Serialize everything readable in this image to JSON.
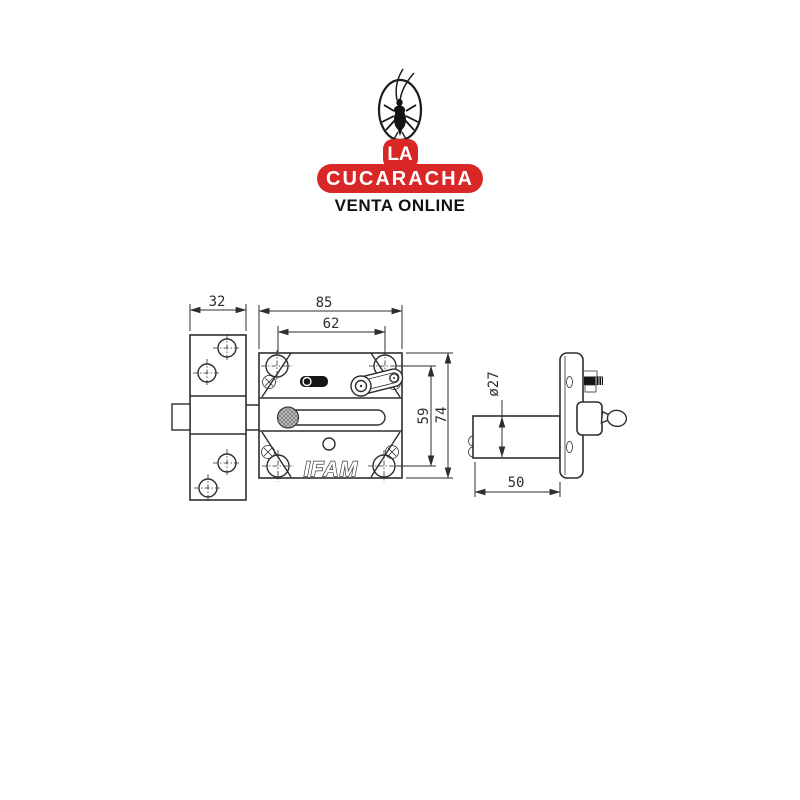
{
  "logo": {
    "brand_line1": "LA",
    "brand_line2": "CUCARACHA",
    "tagline": "VENTA ONLINE",
    "mascot": "cockroach-icon"
  },
  "drawing": {
    "brand_label": "IFAM",
    "dims": {
      "keeper_width": "32",
      "body_width": "85",
      "hole_spacing_horizontal": "62",
      "hole_spacing_vertical": "59",
      "body_height": "74",
      "cylinder_diameter": "ø27",
      "cylinder_length": "50"
    }
  },
  "colors": {
    "accent_red": "#d92727",
    "line": "#2e2e2e",
    "background": "#ffffff"
  }
}
